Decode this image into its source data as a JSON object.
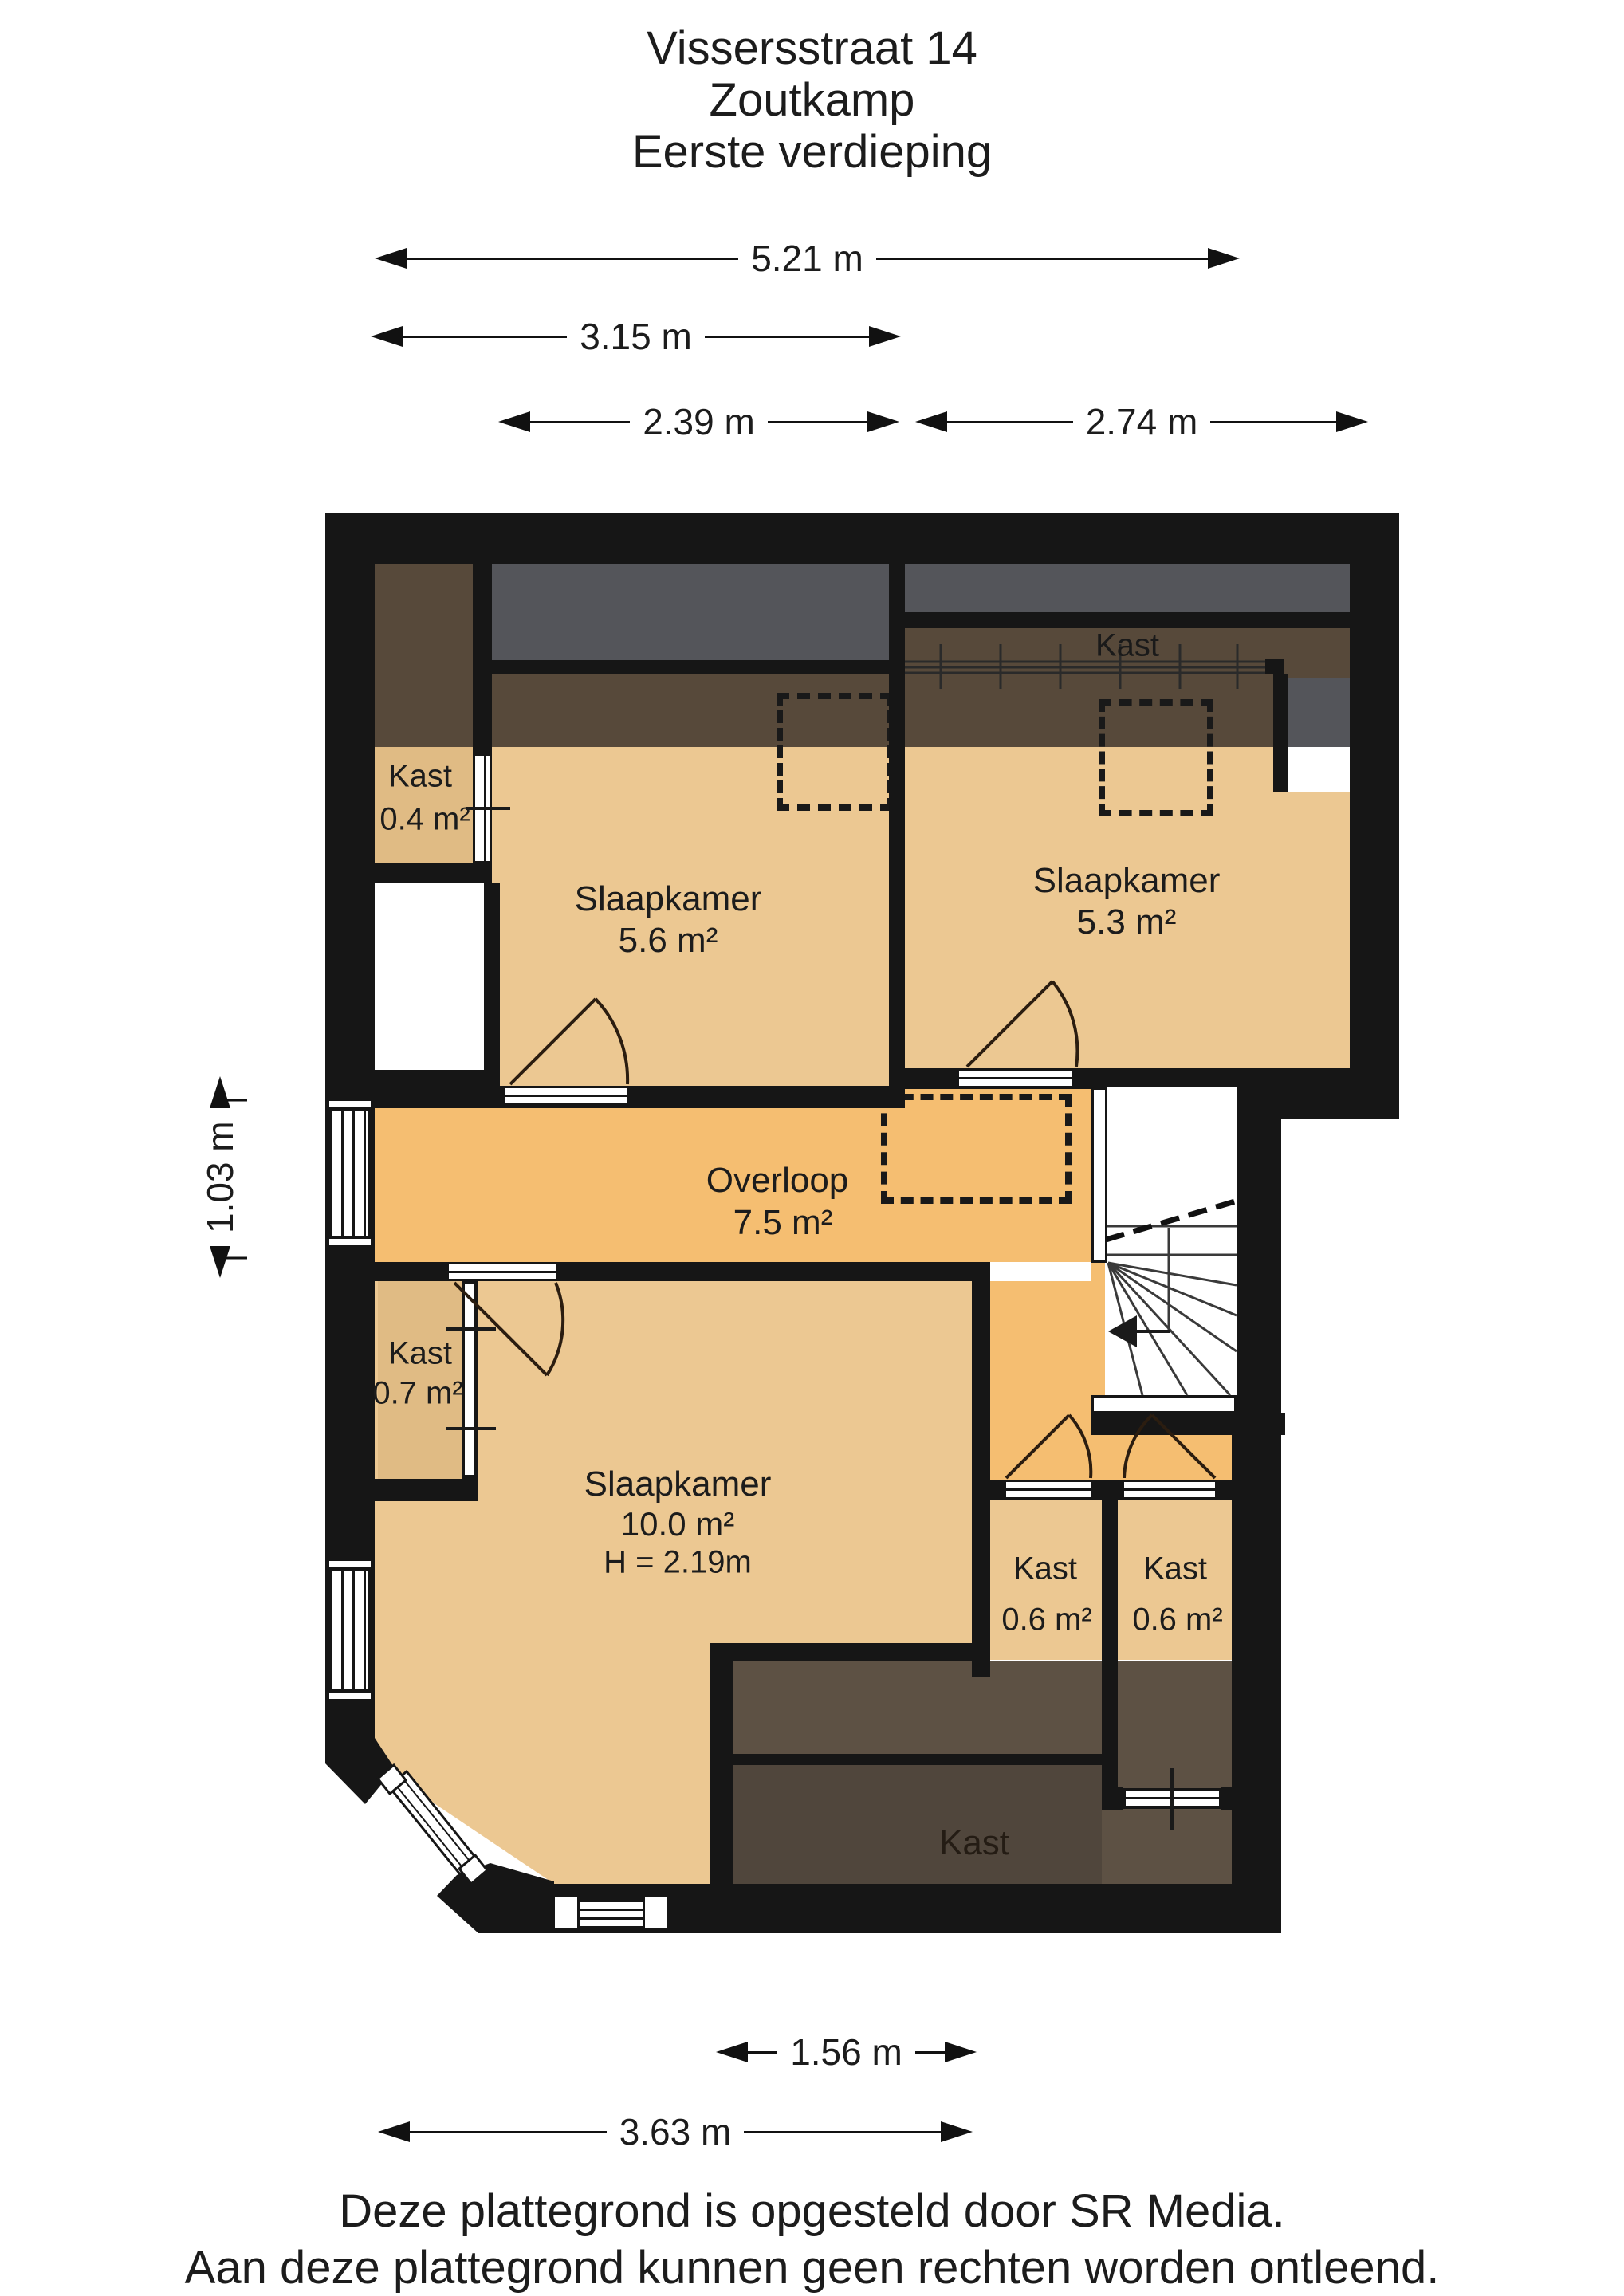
{
  "title": {
    "line1": "Vissersstraat 14",
    "line2": "Zoutkamp",
    "line3": "Eerste verdieping"
  },
  "dimensions": {
    "top1": "5.21 m",
    "top2": "3.15 m",
    "top3a": "2.39 m",
    "top3b": "2.74 m",
    "left": "1.03 m",
    "bottom1": "1.56 m",
    "bottom2": "3.63 m"
  },
  "rooms": {
    "kast04": {
      "name": "Kast",
      "area": "0.4 m²"
    },
    "s56": {
      "name": "Slaapkamer",
      "area": "5.6 m²"
    },
    "kast_top": {
      "name": "Kast"
    },
    "s53": {
      "name": "Slaapkamer",
      "area": "5.3 m²"
    },
    "overloop": {
      "name": "Overloop",
      "area": "7.5 m²"
    },
    "kast07": {
      "name": "Kast",
      "area": "0.7 m²"
    },
    "s10": {
      "name": "Slaapkamer",
      "area": "10.0 m²",
      "height": "H = 2.19m"
    },
    "kast06l": {
      "name": "Kast",
      "area": "0.6 m²"
    },
    "kast06r": {
      "name": "Kast",
      "area": "0.6 m²"
    },
    "kast_bottom": {
      "name": "Kast"
    }
  },
  "footer": {
    "line1": "Deze plattegrond is opgesteld door SR Media.",
    "line2": "Aan deze plattegrond kunnen geen rechten worden ontleend."
  },
  "colors": {
    "wall": "#161616",
    "tan": "#ECC892",
    "kastTan": "#E0BB84",
    "orange": "#F5BE71",
    "gray": "#54555A",
    "brownBand": "#57493A",
    "brownZone": "#5D5144",
    "brownZoneDark": "#50463C"
  }
}
